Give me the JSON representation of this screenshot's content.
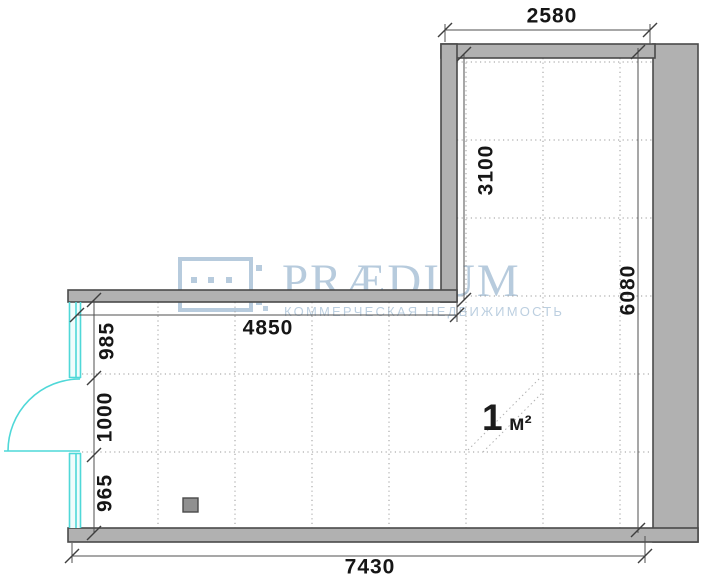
{
  "dimensions_mm": {
    "top_width": "2580",
    "upper_section_height": "3100",
    "right_side_height": "6080",
    "lower_section_top": "4850",
    "left_upper_window": "985",
    "door_opening": "1000",
    "left_lower_window": "965",
    "bottom_width": "7430"
  },
  "area_label": {
    "value": "1",
    "unit": "м²"
  },
  "watermark": {
    "brand": "PRÆDIUM",
    "tagline": "КОММЕРЧЕСКАЯ НЕДВИЖИМОСТЬ"
  },
  "colors": {
    "wall_fill": "#b1b1b1",
    "wall_outline": "#4a4a4a",
    "glazing_cyan": "#4fd8d8",
    "grid_gray": "#9a9a9a",
    "dimension_text": "#161616",
    "watermark_blue": "#b7cbdd"
  }
}
